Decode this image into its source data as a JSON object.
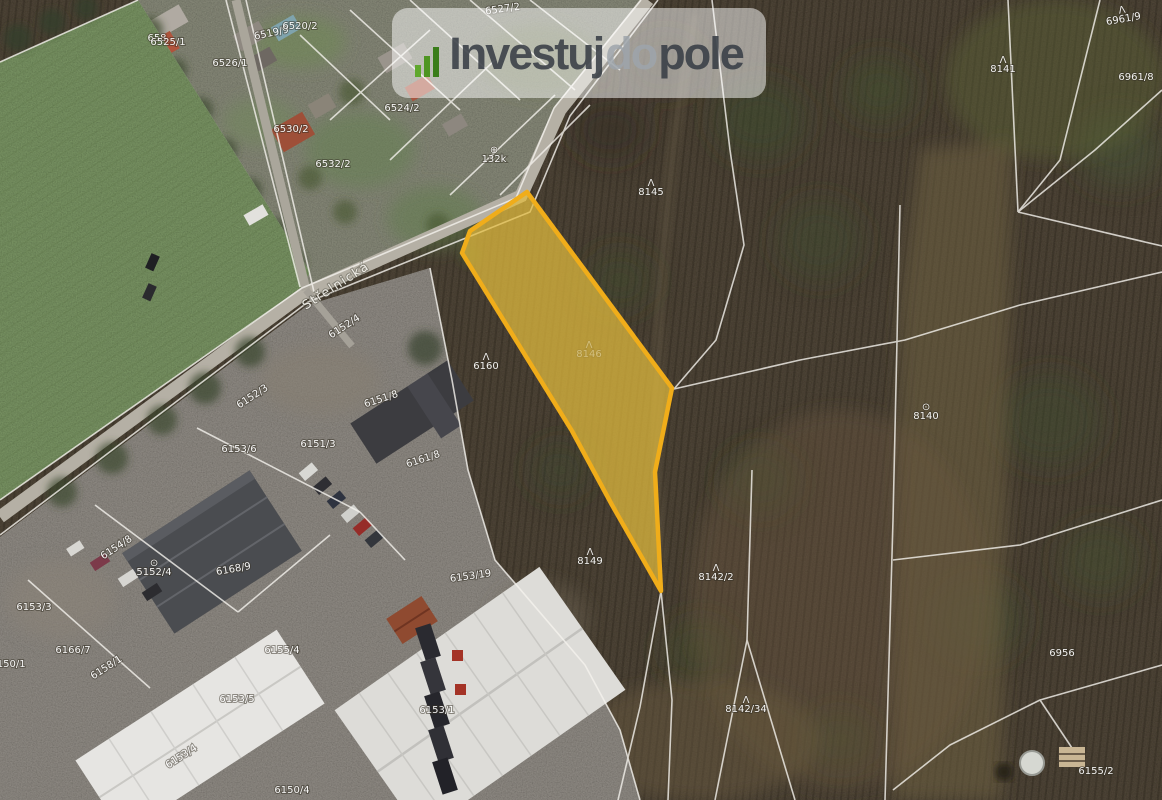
{
  "logo": {
    "part1": "Investuj",
    "part2": "do",
    "part3": "pole",
    "icon": "growth-bars-icon",
    "colors": {
      "dark": "#383E46",
      "light": "#9EA4AB",
      "green": "#4E9522",
      "bg": "rgba(255,255,255,0.5)"
    }
  },
  "map": {
    "street": {
      "label": "Střelnická",
      "x": 338,
      "y": 289,
      "rot": -33
    },
    "highlighted_parcel": {
      "label": "8146",
      "fill": "#E3BC3F",
      "fill_opacity": 0.72,
      "stroke": "#F0AD1A",
      "points": [
        [
          527,
          192
        ],
        [
          672,
          388
        ],
        [
          655,
          472
        ],
        [
          661,
          591
        ],
        [
          612,
          505
        ],
        [
          572,
          431
        ],
        [
          462,
          253
        ],
        [
          470,
          231
        ]
      ]
    },
    "line_color": "#F5F3EE",
    "parcel_labels": [
      {
        "text": "6527/2",
        "x": 503,
        "y": 12,
        "rot": -8
      },
      {
        "text": "6519/9",
        "x": 272,
        "y": 36,
        "rot": -12
      },
      {
        "text": "658",
        "x": 157,
        "y": 41
      },
      {
        "text": "6526/1",
        "x": 230,
        "y": 66
      },
      {
        "text": "6525/1",
        "x": 168,
        "y": 45
      },
      {
        "text": "6520/2",
        "x": 300,
        "y": 29
      },
      {
        "text": "6530/2",
        "x": 291,
        "y": 132
      },
      {
        "text": "6532/2",
        "x": 333,
        "y": 167
      },
      {
        "text": "6524/2",
        "x": 402,
        "y": 111
      },
      {
        "text": "132k",
        "x": 494,
        "y": 162,
        "symbol": "⊕"
      },
      {
        "text": "8141",
        "x": 1003,
        "y": 72,
        "symbol": "Λ"
      },
      {
        "text": "6961/9",
        "x": 1124,
        "y": 22,
        "rot": -10,
        "symbol": "Λ"
      },
      {
        "text": "6961/8",
        "x": 1136,
        "y": 80
      },
      {
        "text": "8145",
        "x": 651,
        "y": 195,
        "symbol": "Λ"
      },
      {
        "text": "8146",
        "x": 589,
        "y": 357,
        "symbol": "Λ",
        "faint": true
      },
      {
        "text": "6160",
        "x": 486,
        "y": 369,
        "symbol": "Λ"
      },
      {
        "text": "8140",
        "x": 926,
        "y": 419,
        "symbol": "⊙"
      },
      {
        "text": "8149",
        "x": 590,
        "y": 564,
        "symbol": "Λ"
      },
      {
        "text": "8142/2",
        "x": 716,
        "y": 580,
        "symbol": "Λ"
      },
      {
        "text": "8142/34",
        "x": 746,
        "y": 712,
        "symbol": "Λ"
      },
      {
        "text": "6956",
        "x": 1062,
        "y": 656
      },
      {
        "text": "6155/2",
        "x": 1096,
        "y": 774
      },
      {
        "text": "6152/4",
        "x": 346,
        "y": 329,
        "rot": -33
      },
      {
        "text": "6152/3",
        "x": 254,
        "y": 399,
        "rot": -33
      },
      {
        "text": "6151/8",
        "x": 382,
        "y": 402,
        "rot": -18
      },
      {
        "text": "6151/3",
        "x": 318,
        "y": 447
      },
      {
        "text": "6153/6",
        "x": 239,
        "y": 452
      },
      {
        "text": "6161/8",
        "x": 424,
        "y": 462,
        "rot": -18
      },
      {
        "text": "6153/19",
        "x": 471,
        "y": 579,
        "rot": -8
      },
      {
        "text": "6154/8",
        "x": 118,
        "y": 550,
        "rot": -33
      },
      {
        "text": "5152/4",
        "x": 154,
        "y": 575,
        "symbol": "⊙"
      },
      {
        "text": "6168/9",
        "x": 234,
        "y": 572,
        "rot": -10
      },
      {
        "text": "6153/3",
        "x": 34,
        "y": 610
      },
      {
        "text": "6166/7",
        "x": 73,
        "y": 653
      },
      {
        "text": "6155/4",
        "x": 282,
        "y": 653
      },
      {
        "text": "6158/1",
        "x": 108,
        "y": 670,
        "rot": -33
      },
      {
        "text": "6153/5",
        "x": 237,
        "y": 702
      },
      {
        "text": "6150/1",
        "x": 8,
        "y": 667
      },
      {
        "text": "6153/4",
        "x": 183,
        "y": 759,
        "rot": -33
      },
      {
        "text": "6153/1",
        "x": 437,
        "y": 713
      },
      {
        "text": "6150/4",
        "x": 292,
        "y": 793
      }
    ]
  }
}
